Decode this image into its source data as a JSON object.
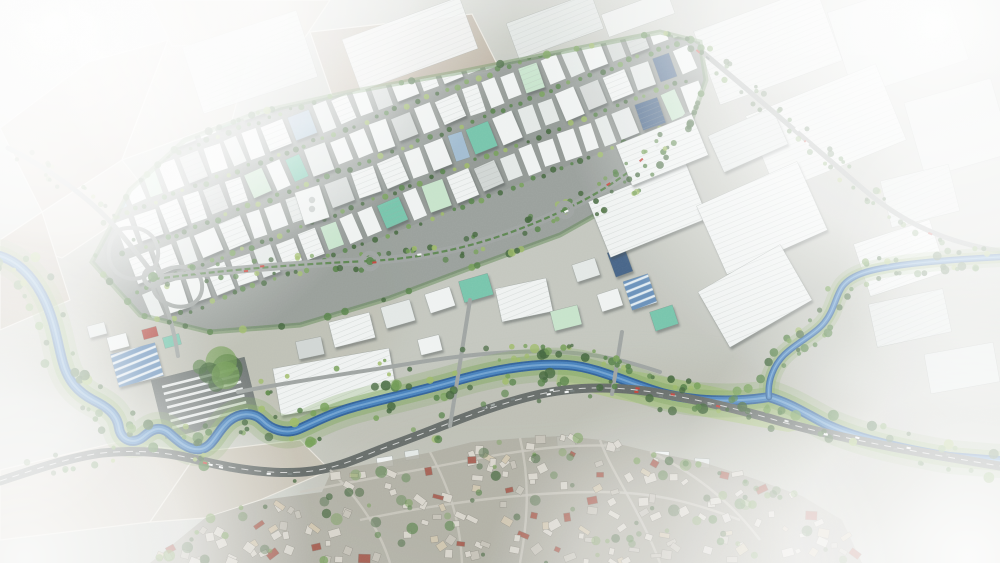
{
  "meta": {
    "type": "aerial-render",
    "description": "Aerial photomontage render of a riverside organized industrial zone: dense diagonal grid of warehouses with white, mint, red, navy and teal roofs, tree-lined streets and a green boulevard, large logistics warehouses to the east, a meandering blue river joined by a tributary, a dark highway corridor, a truck yard, and a dense low-rise residential district to the south; image edges fade into white haze.",
    "canvas": {
      "width": 1000,
      "height": 563
    }
  },
  "palette": {
    "base": "#cbcec7",
    "field_tan": "#b7a996",
    "field_gray": "#c6c0b2",
    "field_pale": "#cfc9bc",
    "field_dirt": "#b3a795",
    "field_line": "#e9e6dd",
    "asphalt": "#8a918d",
    "asphalt_dark": "#6d7472",
    "road": "#9aa09d",
    "road_dark": "#5f6663",
    "lane": "#f5f6f4",
    "river_deep": "#275a95",
    "river_mid": "#3f7cba",
    "river_light": "#7fb0d8",
    "bank_green": "#7da45c",
    "tree_dark": "#3a5f33",
    "tree_mid": "#4e7c3f",
    "tree_light": "#6f9b4f",
    "tree_yellow": "#9ab860",
    "park": "#a8c07e",
    "roof_white": "#eff2f1",
    "roof_offwhite": "#e2e7e5",
    "roof_gray": "#cfd4d2",
    "roof_mint": "#c4e2c9",
    "roof_teal": "#6fc2a8",
    "roof_red": "#ad3d34",
    "roof_navy": "#3d5c82",
    "roof_steel": "#9db9cf",
    "rib_line": "#9aa3a0",
    "bldg_stroke": "#6b736f",
    "residential_base": "#a9a89c",
    "res_wall": "#d8d5cc",
    "res_mid": "#c4c1b7",
    "res_warm": "#cfc4ad",
    "res_red": "#a2584a",
    "res_street": "#c8c5bc",
    "res_stroke": "#8a887e",
    "mottle1": "#b7bab0",
    "mottle2": "#b3b19f",
    "mottle3": "#b0afa2",
    "fog": "#ffffff"
  },
  "paths": {
    "river_main": "M 0,256 C 22,263 36,281 46,303 C 56,326 58,346 63,363 C 68,381 78,392 93,400 C 107,407 117,414 119,428 C 121,440 133,445 143,437 C 151,430 159,425 169,433 C 179,442 189,451 201,449 C 213,447 217,431 229,421 C 239,413 253,411 263,421 C 271,429 285,435 299,429 C 315,422 332,413 354,407 C 382,399 422,391 462,379 C 502,368 537,363 567,365 C 597,367 627,383 662,393 C 692,401 734,403 769,397 C 792,404 808,415 828,425 C 858,439 902,449 950,457 L 1000,461",
    "river_tributary": "M 1000,257 C 962,259 932,261 902,265 C 874,269 852,273 842,287 C 835,298 834,311 824,323 C 814,335 796,343 784,355 C 774,365 767,381 769,397",
    "highway": "M 0,481 C 42,467 72,457 102,453 C 142,449 172,453 202,461 C 242,471 282,475 312,471 C 342,467 362,456 392,445 C 432,431 482,408 532,396 C 572,386 612,386 652,392 C 702,400 742,410 782,422 C 832,436 892,448 1000,466",
    "boulevard": "M 155,279 C 240,268 320,263 370,261 C 442,257 502,239 562,211 C 612,188 652,158 688,116",
    "ne_corridor": "M 690,42 C 742,84 806,140 862,188 C 906,226 950,243 1000,251",
    "hw_northwest": "M 8,148 C 48,168 90,198 116,228 C 136,252 146,264 154,276",
    "interchange_ramp_a": "M 118,230 C 142,222 160,236 158,256 C 156,274 138,284 122,276 C 106,268 104,246 118,230",
    "interchange_ramp_b": "M 154,276 C 178,260 200,266 202,284 C 204,302 186,312 168,304 C 156,299 150,290 154,276",
    "south_link": "M 154,278 C 168,306 174,330 178,356",
    "north_bank_road": "M 238,392 C 300,380 360,372 420,362 C 470,354 520,350 560,352 C 600,354 630,362 660,372",
    "connectors": [
      "M 470,300 L 450,426",
      "M 622,332 L 612,394"
    ],
    "residential_streets": [
      "M 330,470 C 360,500 380,530 390,563",
      "M 430,452 C 450,490 460,520 462,563",
      "M 520,438 C 530,480 528,520 520,563",
      "M 600,440 C 610,470 640,510 660,563",
      "M 650,452 C 690,470 730,500 760,540",
      "M 300,492 C 360,480 420,470 480,458 C 540,447 580,444 620,446",
      "M 360,520 C 430,505 520,492 600,492 C 660,492 700,505 740,520"
    ]
  },
  "zones": {
    "industrial_clip": "92,262 130,190 185,140 260,112 350,92 460,72 570,50 660,32 700,42 706,80 688,130 640,190 560,235 470,268 390,298 300,325 210,332 140,315",
    "residential_poly": "150,563 205,518 262,500 322,492 332,470 382,462 432,452 472,442 522,438 562,436 602,440 652,452 702,462 752,478 802,496 842,520 862,563",
    "park_strip": "560,362 640,372 720,388 790,408 832,424 788,432 700,416 612,398 556,384",
    "farm_fields": [
      {
        "points": "0,128 88,62 168,40 122,160 42,212",
        "fill": "field_tan"
      },
      {
        "points": "122,160 168,40 258,22 232,120",
        "fill": "field_gray"
      },
      {
        "points": "0,240 42,212 122,160 152,198 62,258",
        "fill": "field_pale"
      },
      {
        "points": "150,0 330,0 302,42 172,46",
        "fill": "field_gray"
      },
      {
        "points": "42,212 0,240 0,330 70,300",
        "fill": "field_tan"
      },
      {
        "points": "310,32 472,14 500,70 332,96",
        "fill": "field_dirt"
      },
      {
        "points": "0,470 118,442 198,452 150,522 0,540",
        "fill": "field_pale"
      },
      {
        "points": "198,452 300,440 330,470 260,500 205,518 150,522",
        "fill": "field_gray"
      }
    ]
  },
  "industrial": {
    "grid": {
      "origin": [
        140,
        300
      ],
      "angle_deg": -21,
      "v_start": -238,
      "v_end": -10,
      "v_step": 38,
      "u_start": 4,
      "u_end": 600,
      "gap": 5,
      "w_min": 13,
      "w_max": 24,
      "h": 28,
      "seed": 11,
      "roof_weights": [
        [
          "roof_white",
          50
        ],
        [
          "roof_offwhite",
          18
        ],
        [
          "roof_gray",
          9
        ],
        [
          "roof_mint",
          8
        ],
        [
          "roof_steel",
          5
        ],
        [
          "roof_teal",
          4
        ],
        [
          "roof_red",
          3
        ],
        [
          "roof_navy",
          3
        ]
      ]
    },
    "landmark_buildings": [
      {
        "cx": 352,
        "cy": 330,
        "w": 42,
        "h": 26,
        "rot": -14,
        "roof": "roof_white",
        "rib": true
      },
      {
        "cx": 398,
        "cy": 314,
        "w": 30,
        "h": 22,
        "rot": -16,
        "roof": "roof_offwhite"
      },
      {
        "cx": 440,
        "cy": 300,
        "w": 26,
        "h": 20,
        "rot": -18,
        "roof": "roof_white"
      },
      {
        "cx": 476,
        "cy": 288,
        "w": 30,
        "h": 22,
        "rot": -16,
        "roof": "roof_teal"
      },
      {
        "cx": 524,
        "cy": 300,
        "w": 52,
        "h": 34,
        "rot": -12,
        "roof": "roof_white",
        "rib": true
      },
      {
        "cx": 566,
        "cy": 318,
        "w": 28,
        "h": 20,
        "rot": -14,
        "roof": "roof_mint"
      },
      {
        "cx": 310,
        "cy": 348,
        "w": 26,
        "h": 18,
        "rot": -12,
        "roof": "roof_gray"
      },
      {
        "cx": 335,
        "cy": 382,
        "w": 118,
        "h": 48,
        "rot": -10,
        "roof": "roof_white",
        "rib": true
      },
      {
        "cx": 430,
        "cy": 345,
        "w": 22,
        "h": 16,
        "rot": -14,
        "roof": "roof_white"
      },
      {
        "cx": 620,
        "cy": 262,
        "w": 18,
        "h": 26,
        "rot": -20,
        "roof": "roof_navy"
      },
      {
        "cx": 640,
        "cy": 292,
        "w": 26,
        "h": 30,
        "rot": -18,
        "roof": "roof_steel",
        "stripes": true
      },
      {
        "cx": 664,
        "cy": 318,
        "w": 24,
        "h": 20,
        "rot": -18,
        "roof": "roof_teal"
      },
      {
        "cx": 610,
        "cy": 300,
        "w": 22,
        "h": 18,
        "rot": -18,
        "roof": "roof_white"
      },
      {
        "cx": 586,
        "cy": 270,
        "w": 24,
        "h": 18,
        "rot": -18,
        "roof": "roof_offwhite"
      },
      {
        "cx": 648,
        "cy": 210,
        "w": 105,
        "h": 60,
        "rot": -22,
        "roof": "roof_white",
        "rib": true
      },
      {
        "cx": 762,
        "cy": 218,
        "w": 110,
        "h": 75,
        "rot": -24,
        "roof": "roof_white",
        "rib": true
      },
      {
        "cx": 755,
        "cy": 296,
        "w": 95,
        "h": 64,
        "rot": -30,
        "roof": "roof_white",
        "rib": true
      },
      {
        "cx": 662,
        "cy": 150,
        "w": 82,
        "h": 44,
        "rot": -22,
        "roof": "roof_white",
        "rib": true
      },
      {
        "cx": 748,
        "cy": 140,
        "w": 70,
        "h": 40,
        "rot": -24,
        "roof": "roof_offwhite",
        "rib": true
      },
      {
        "cx": 137,
        "cy": 365,
        "w": 46,
        "h": 34,
        "rot": -15,
        "roof": "roof_steel",
        "stripes": true
      },
      {
        "cx": 150,
        "cy": 333,
        "w": 15,
        "h": 10,
        "rot": -15,
        "roof": "roof_red"
      },
      {
        "cx": 172,
        "cy": 341,
        "w": 17,
        "h": 11,
        "rot": -15,
        "roof": "roof_teal"
      },
      {
        "cx": 118,
        "cy": 342,
        "w": 20,
        "h": 14,
        "rot": -15,
        "roof": "roof_white"
      },
      {
        "cx": 97,
        "cy": 330,
        "w": 18,
        "h": 12,
        "rot": -15,
        "roof": "roof_offwhite"
      },
      {
        "cx": 312,
        "cy": 205,
        "w": 26,
        "h": 34,
        "rot": -18,
        "roof": "roof_white",
        "mark": true
      },
      {
        "cx": 385,
        "cy": 462,
        "w": 16,
        "h": 10,
        "rot": -8,
        "roof": "roof_white"
      },
      {
        "cx": 412,
        "cy": 455,
        "w": 14,
        "h": 9,
        "rot": -8,
        "roof": "roof_offwhite"
      },
      {
        "cx": 566,
        "cy": 441,
        "w": 18,
        "h": 10,
        "rot": -4,
        "roof": "roof_white"
      },
      {
        "cx": 612,
        "cy": 447,
        "w": 16,
        "h": 9,
        "rot": -2,
        "roof": "roof_offwhite"
      },
      {
        "cx": 662,
        "cy": 456,
        "w": 14,
        "h": 9,
        "rot": 2,
        "roof": "roof_white"
      },
      {
        "cx": 702,
        "cy": 463,
        "w": 15,
        "h": 9,
        "rot": 4,
        "roof": "roof_offwhite"
      }
    ],
    "faded_buildings": [
      {
        "cx": 250,
        "cy": 62,
        "w": 120,
        "h": 70,
        "rot": -18,
        "roof": "roof_offwhite",
        "rib": true,
        "op": 0.85
      },
      {
        "cx": 410,
        "cy": 44,
        "w": 125,
        "h": 55,
        "rot": -20,
        "roof": "roof_white",
        "rib": true,
        "op": 0.9
      },
      {
        "cx": 555,
        "cy": 26,
        "w": 90,
        "h": 38,
        "rot": -20,
        "roof": "roof_offwhite",
        "rib": true,
        "op": 0.85
      },
      {
        "cx": 638,
        "cy": 14,
        "w": 70,
        "h": 24,
        "rot": -20,
        "roof": "roof_white",
        "op": 0.8
      },
      {
        "cx": 768,
        "cy": 46,
        "w": 130,
        "h": 78,
        "rot": -20,
        "roof": "roof_white",
        "rib": true,
        "op": 0.85
      },
      {
        "cx": 898,
        "cy": 36,
        "w": 120,
        "h": 88,
        "rot": -18,
        "roof": "roof_offwhite",
        "op": 0.85
      },
      {
        "cx": 826,
        "cy": 128,
        "w": 140,
        "h": 82,
        "rot": -22,
        "roof": "roof_white",
        "rib": true,
        "op": 0.9
      },
      {
        "cx": 958,
        "cy": 128,
        "w": 90,
        "h": 78,
        "rot": -16,
        "roof": "roof_offwhite",
        "op": 0.85
      },
      {
        "cx": 920,
        "cy": 196,
        "w": 70,
        "h": 48,
        "rot": -14,
        "roof": "roof_offwhite",
        "rib": true,
        "op": 0.95
      },
      {
        "cx": 900,
        "cy": 258,
        "w": 80,
        "h": 55,
        "rot": -18,
        "roof": "roof_white",
        "rib": true,
        "op": 0.95
      },
      {
        "cx": 910,
        "cy": 318,
        "w": 76,
        "h": 44,
        "rot": -12,
        "roof": "roof_offwhite",
        "rib": true,
        "op": 0.95
      },
      {
        "cx": 962,
        "cy": 368,
        "w": 70,
        "h": 40,
        "rot": -10,
        "roof": "roof_offwhite",
        "op": 0.9
      }
    ],
    "truck_yard": {
      "cx": 205,
      "cy": 398,
      "w": 96,
      "h": 60,
      "rot": -14,
      "rows": 7,
      "strip_len": 78
    },
    "roundabouts": [
      [
        153,
        277,
        9
      ],
      [
        370,
        261,
        8
      ],
      [
        565,
        210,
        7
      ]
    ]
  },
  "residential": {
    "seed": 23,
    "building_count": 175,
    "tree_count": 95,
    "size": {
      "wmin": 5,
      "wmax": 12,
      "hmin": 4,
      "hmax": 9
    },
    "roof_weights": [
      [
        "res_wall",
        52
      ],
      [
        "res_mid",
        22
      ],
      [
        "res_warm",
        12
      ],
      [
        "res_red",
        14
      ]
    ]
  },
  "vegetation": {
    "seed": 5,
    "along": [
      {
        "path": "river_main",
        "count": 135,
        "omin": 6,
        "omax": 18,
        "rmin": 2,
        "rmax": 5.5,
        "op": 0.9
      },
      {
        "path": "river_tributary",
        "count": 45,
        "omin": 5,
        "omax": 12,
        "rmin": 2,
        "rmax": 4.5,
        "op": 0.9
      },
      {
        "path": "boulevard",
        "count": 75,
        "omin": 5,
        "omax": 9,
        "rmin": 1.6,
        "rmax": 3.2,
        "op": 0.9
      },
      {
        "path": "ne_corridor",
        "count": 42,
        "omin": 4,
        "omax": 9,
        "rmin": 1.8,
        "rmax": 3.6,
        "op": 0.85
      },
      {
        "path": "highway",
        "count": 34,
        "omin": 6,
        "omax": 11,
        "rmin": 1.8,
        "rmax": 4,
        "op": 0.8
      },
      {
        "path": "north_bank_road",
        "count": 26,
        "omin": 4,
        "omax": 8,
        "rmin": 1.6,
        "rmax": 3,
        "op": 0.85
      },
      {
        "path": "hw_northwest",
        "count": 18,
        "omin": 4,
        "omax": 8,
        "rmin": 1.6,
        "rmax": 3,
        "op": 0.8
      }
    ],
    "perimeter_trees": 70,
    "hill": {
      "cx": 212,
      "cy": 372,
      "blobs": 6
    }
  },
  "traffic": {
    "seed": 9,
    "routes": [
      {
        "path": "highway",
        "count": 26
      },
      {
        "path": "boulevard",
        "count": 8
      },
      {
        "path": "ne_corridor",
        "count": 6
      }
    ],
    "colors": [
      "#f4f6f5",
      "#dfe3e2",
      "#9aa3a1",
      "#6d7775",
      "#c23b32"
    ]
  },
  "fog": {
    "patches": [
      {
        "cx": 55,
        "cy": 25,
        "r": 370,
        "o": 0.97
      },
      {
        "cx": 20,
        "cy": 150,
        "r": 230,
        "o": 0.7
      },
      {
        "cx": 265,
        "cy": -10,
        "r": 250,
        "o": 0.75
      },
      {
        "cx": 935,
        "cy": 25,
        "r": 390,
        "o": 0.97
      },
      {
        "cx": 1005,
        "cy": 255,
        "r": 170,
        "o": 0.45
      },
      {
        "cx": 968,
        "cy": 558,
        "r": 310,
        "o": 0.93
      },
      {
        "cx": 690,
        "cy": 595,
        "r": 210,
        "o": 0.55
      },
      {
        "cx": 25,
        "cy": 558,
        "r": 290,
        "o": 0.88
      },
      {
        "cx": -5,
        "cy": 385,
        "r": 150,
        "o": 0.5
      }
    ],
    "top_fade_opacity": 0.25,
    "haze_opacity": 0.05
  }
}
